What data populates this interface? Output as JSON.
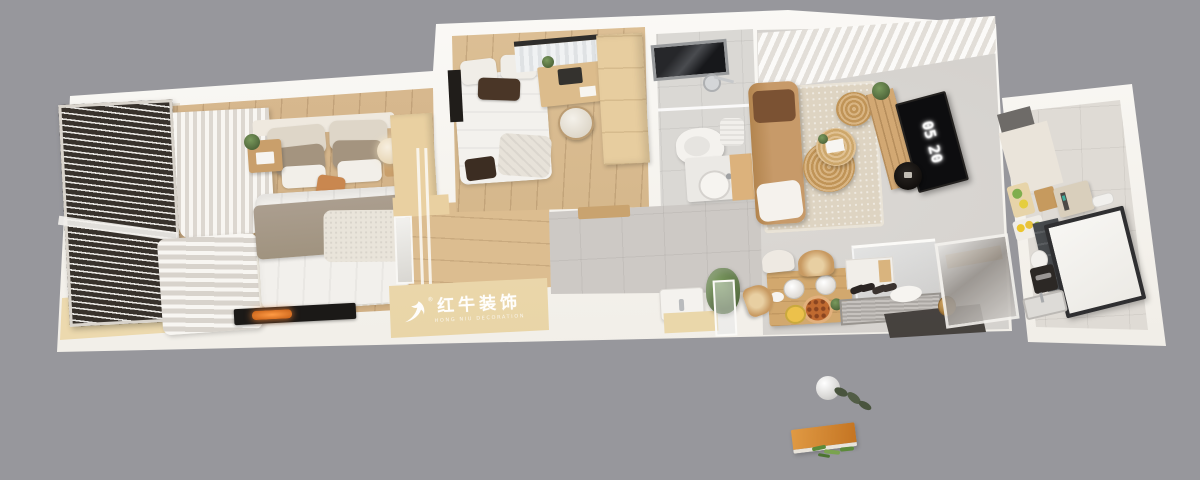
{
  "watermark": {
    "registered": "®",
    "title_cn": "红牛装饰",
    "subtitle_en": "HONG NIU DECORATION"
  },
  "tv_screen": {
    "clock_hours": "05",
    "clock_minutes": "20"
  },
  "icons": {
    "bull_logo": "red-bull-decoration brand bull swoosh, white"
  },
  "palette": {
    "background": "#97979c",
    "wall_white": "#f7f4ef",
    "bedroom_wood": "#d5b283",
    "hall_wood": "#dcbd90",
    "tan_cabinet": "#ead7aa",
    "gray_tile": "#cdc9c5",
    "living_floor": "#d4d1cd",
    "rug_beige": "#ddd3c0",
    "blinds_dark": "#38322c",
    "sofa_tan": "#c79a69",
    "accent_pillow": "#c9874f",
    "rattan": "#d3ae7c",
    "tv_black": "#0d0d0f",
    "entry_dark": "#4b4744",
    "board_orange": "#d8882f",
    "plant_green": "#5d7a45"
  }
}
